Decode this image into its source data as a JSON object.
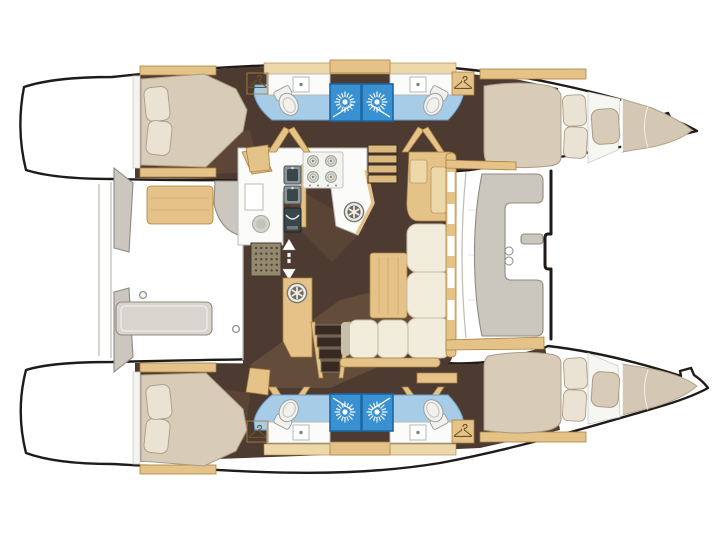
{
  "image": {
    "type": "yacht-floor-plan",
    "vessel": "catamaran",
    "view": "top-down-deck-layout"
  },
  "areas": [
    "aft-cockpit",
    "saloon",
    "galley",
    "nav-station",
    "forward-cockpit",
    "foredeck-trampoline",
    "port-aft-cabin",
    "port-aft-bathroom",
    "port-forward-bathroom",
    "port-forward-cabin",
    "starboard-aft-cabin",
    "starboard-aft-bathroom",
    "starboard-forward-bathroom",
    "starboard-forward-cabin",
    "port-swim-platform",
    "starboard-swim-platform"
  ],
  "icons": [
    "shower-head-icon",
    "clothes-hanger-icon",
    "toilet-icon",
    "bath-sink-icon",
    "galley-sink-icon",
    "stove-burner-icon",
    "deck-hatch-icon",
    "companionway-arrow-icon",
    "porthole-icon",
    "mooring-ring-icon"
  ],
  "colors": {
    "background": "#ffffff",
    "hull_white": "#ffffff",
    "hull_outline": "#1f1b18",
    "deck_line": "#bdbbb5",
    "interior_floor": "#4d3a30",
    "floor_highlight": "#a5členo",
    "floor_highlight_fix": "#a57f5d",
    "wood": "#e5c288",
    "wood_light": "#edd8a9",
    "wood_dark": "#a8823f",
    "mattress": "#d8ccb8",
    "mattress_edge": "#ab9c84",
    "pillow": "#eae3d4",
    "sofa": "#f1ecdc",
    "sofa_edge": "#c6bfa9",
    "counter": "#fbfbf9",
    "counter_edge": "#b9b9b2",
    "bath_floor": "#a7cce8",
    "bath_edge": "#6fa3cc",
    "shower": "#3a91d1",
    "shower_edge": "#1c67a6",
    "gray_furniture": "#cbc7bf",
    "gray_edge": "#8f8b82",
    "table_gray": "#d8d5ce",
    "sink_steel": "#8b9496",
    "sink_dark": "#39464a",
    "grate": "#93896f",
    "grate_dot": "#4f4836",
    "step_wood": "#dcb97c",
    "step_gap": "#382a20",
    "white_fixture": "#f2f1ec",
    "fixture_edge": "#9aa0a2",
    "stove_panel": "#f3f3f0",
    "burner": "#dededa",
    "burner_edge": "#98988f"
  }
}
